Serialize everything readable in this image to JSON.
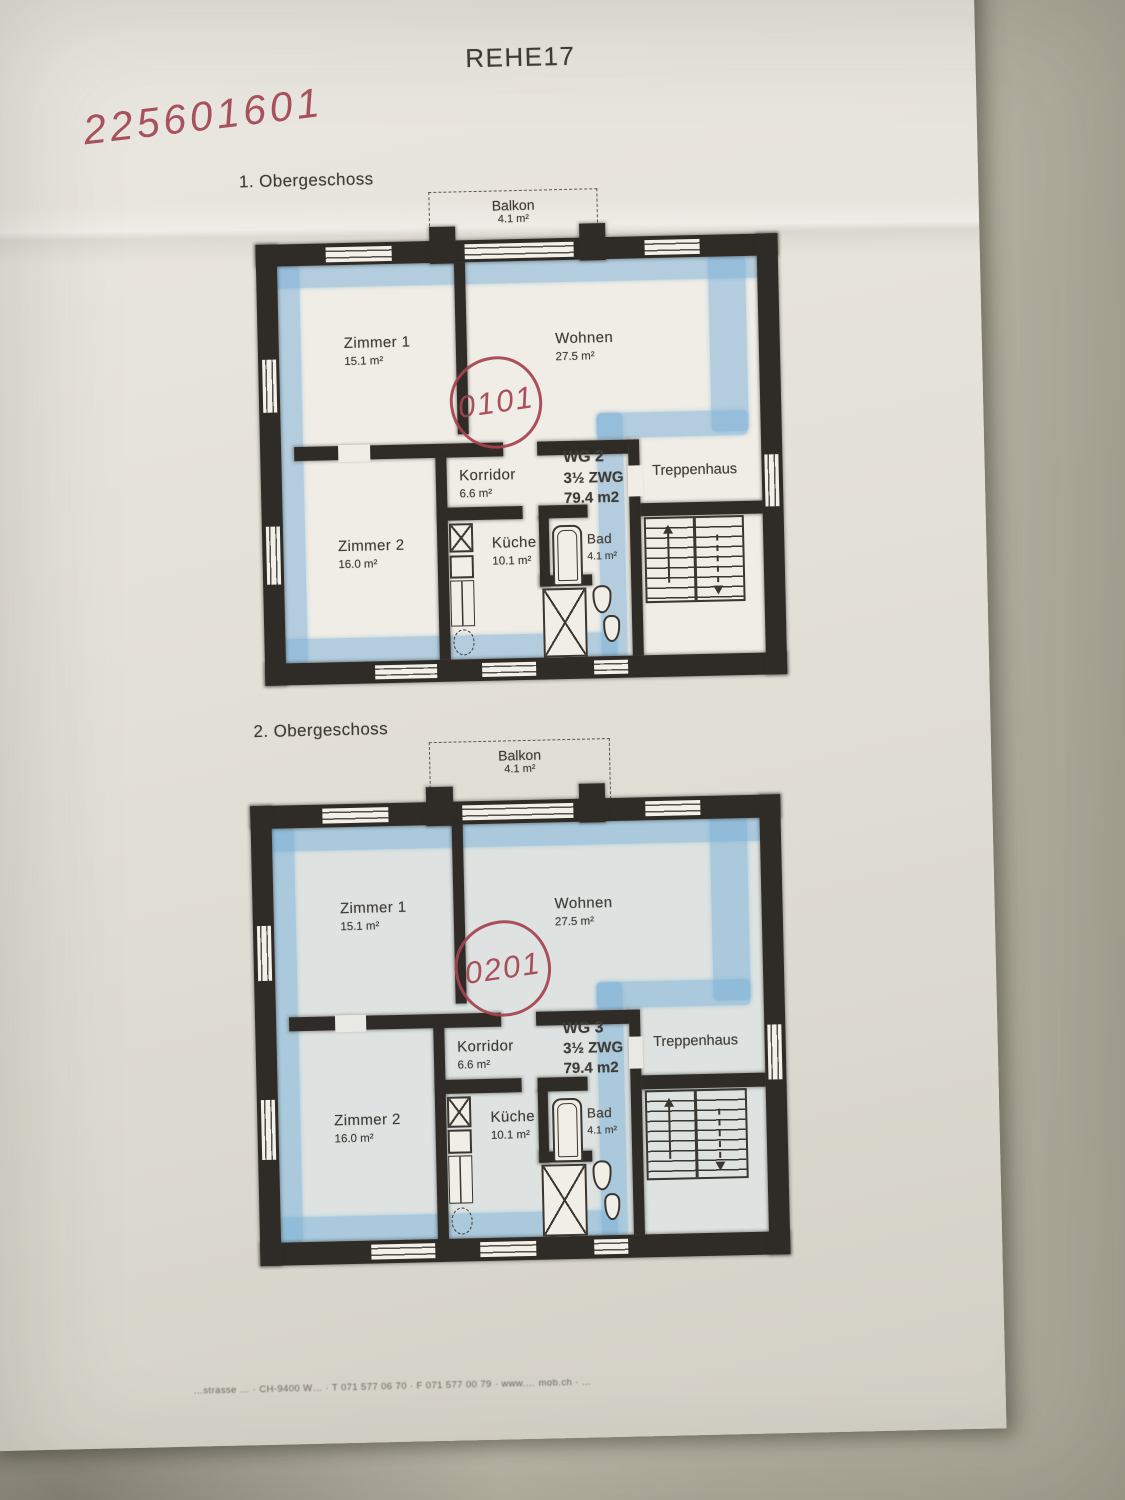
{
  "document": {
    "title": "REHE17",
    "handwritten_code": "225601601",
    "footer_line": "…strasse …  ·  CH-9400 W…  ·  T 071 577 06 70  ·  F 071 577 00 79  ·  www.… mob.ch  ·  …"
  },
  "floors": [
    {
      "label": "1. Obergeschoss",
      "stamp_code": "0101",
      "balcony": {
        "name": "Balkon",
        "area": "4.1 m²"
      },
      "unit": {
        "name": "WG 2",
        "type": "3½ ZWG",
        "area": "79.4 m2"
      },
      "rooms": {
        "zimmer1": {
          "name": "Zimmer 1",
          "area": "15.1 m²"
        },
        "wohnen": {
          "name": "Wohnen",
          "area": "27.5 m²"
        },
        "korridor": {
          "name": "Korridor",
          "area": "6.6 m²"
        },
        "zimmer2": {
          "name": "Zimmer 2",
          "area": "16.0 m²"
        },
        "kueche": {
          "name": "Küche",
          "area": "10.1 m²"
        },
        "bad": {
          "name": "Bad",
          "area": "4.1 m²"
        },
        "treppenhaus": {
          "name": "Treppenhaus"
        }
      }
    },
    {
      "label": "2. Obergeschoss",
      "stamp_code": "0201",
      "balcony": {
        "name": "Balkon",
        "area": "4.1 m²"
      },
      "unit": {
        "name": "WG 3",
        "type": "3½ ZWG",
        "area": "79.4 m2"
      },
      "rooms": {
        "zimmer1": {
          "name": "Zimmer 1",
          "area": "15.1 m²"
        },
        "wohnen": {
          "name": "Wohnen",
          "area": "27.5 m²"
        },
        "korridor": {
          "name": "Korridor",
          "area": "6.6 m²"
        },
        "zimmer2": {
          "name": "Zimmer 2",
          "area": "16.0 m²"
        },
        "kueche": {
          "name": "Küche",
          "area": "10.1 m²"
        },
        "bad": {
          "name": "Bad",
          "area": "4.1 m²"
        },
        "treppenhaus": {
          "name": "Treppenhaus"
        }
      }
    }
  ],
  "colors": {
    "pen_red": "#a6424f",
    "highlight_blue": "#7ab0d6",
    "wall_dark": "#2f2c28",
    "paper": "#e6e3db"
  }
}
